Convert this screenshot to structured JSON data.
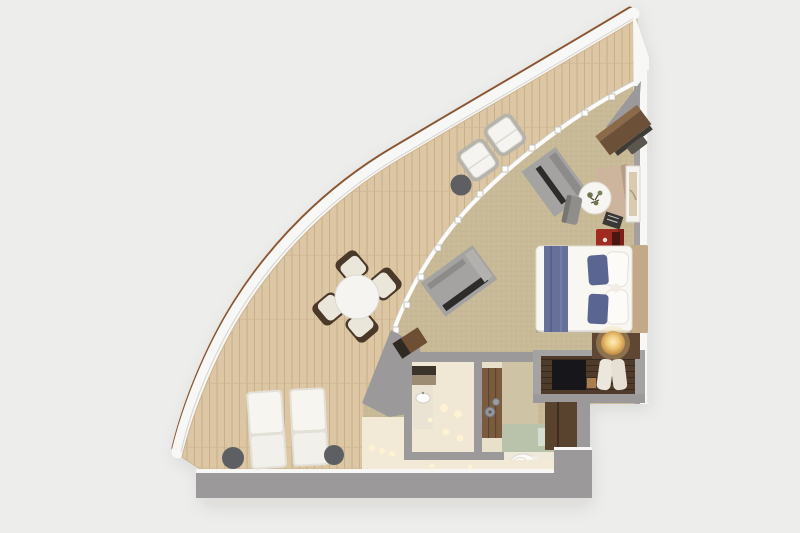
{
  "meta": {
    "title": "Wedge-shaped suite floor plan, top-down 3D render",
    "canvas": {
      "width": 800,
      "height": 533
    },
    "visible_text_items": []
  },
  "palette": {
    "bg": "#ededec",
    "rail-wood": "#8a5632",
    "rim": "#f7f7f5",
    "deck": "#dcc6a3",
    "deck-line": "#c5ad87",
    "carpet": "#c8ba97",
    "wall": "#9b9999",
    "wall-light": "#a3a09d",
    "wood-dark": "#4f3b29",
    "wood-mid": "#5a432e",
    "wood-door": "#7b5b3e",
    "desk-wood": "#6d5038",
    "white-furn": "#f5f4f0",
    "cushion": "#eae6da",
    "chair-frame": "#4a3828",
    "table-dark": "#5d5f62",
    "bed-white": "#f8f7f2",
    "bed-blue": "#667099",
    "pillow-blue": "#5b6592",
    "headboard": "#c3a988",
    "red-accent": "#a02b21",
    "bath-floor": "#f0e7d4",
    "green-floor": "#b9c2ab",
    "tile-dim": "#e8e0ca",
    "cream-floor": "#f2ead6",
    "sofa": "#cdb49c",
    "glow": "#fff3d2",
    "shadow": "#e0deda",
    "hall-wall": "#cfc3a6"
  },
  "legend": {
    "rooms": [
      "curved-teak-balcony",
      "bedroom-sitting-area",
      "bathroom",
      "entry-hall"
    ],
    "balcony_furniture": [
      "sun-lounger x2",
      "lounger-side-table x2",
      "outdoor-dining-table",
      "outdoor-dining-chair x4",
      "balcony-armchair x2",
      "balcony-side-table"
    ],
    "interior_furniture": [
      "desk",
      "desk-chair",
      "sofa",
      "coffee-table-with-plant",
      "side-chair",
      "wall-art",
      "red-side-table",
      "double-bed",
      "blue-pillows x2",
      "nightstand-with-lamp",
      "wardrobe-with-tv-and-robes",
      "vanity-sink",
      "bathroom-door",
      "toilet",
      "luggage-bench"
    ],
    "architecture": [
      "curved-wood-cap-railing",
      "glass-wall-with-mullions",
      "sliding-door-panel x2",
      "exterior-wall-right",
      "exterior-wall-bottom"
    ]
  }
}
